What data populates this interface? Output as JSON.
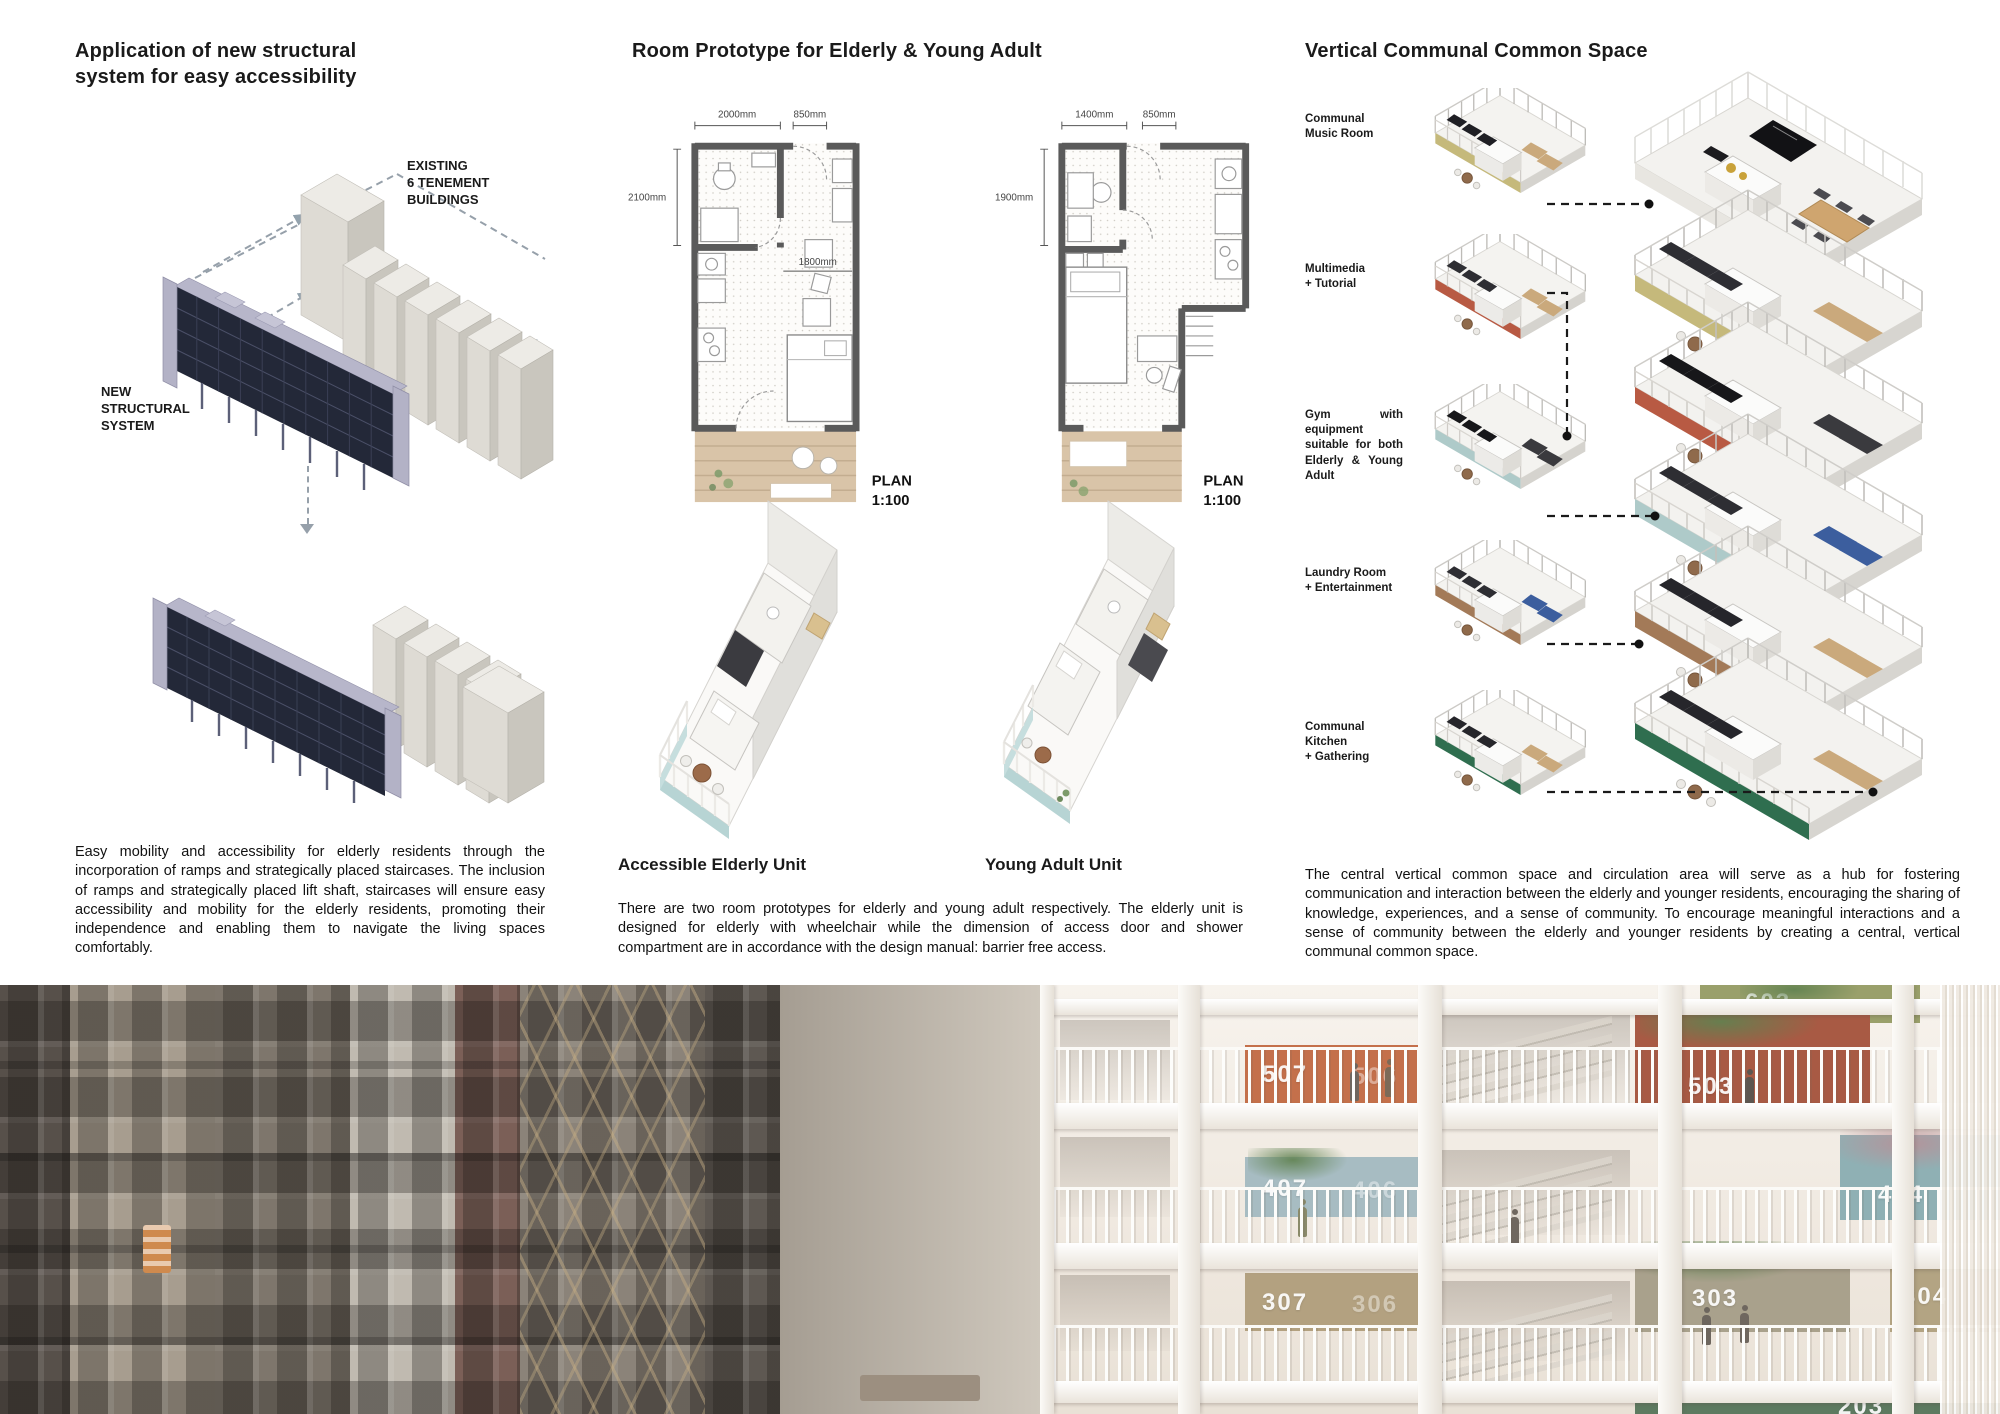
{
  "left": {
    "title": "Application of new structural\nsystem for easy accessibility",
    "existing_label": "EXISTING\n6 TENEMENT\nBUILDINGS",
    "new_label": "NEW\nSTRUCTURAL\nSYSTEM",
    "paragraph": "Easy mobility and accessibility for elderly residents through the incorporation of ramps and strategically placed staircases. The inclusion of ramps and strategically placed lift shaft, staircases will ensure easy accessibility and mobility for the elderly residents, promoting their independence and enabling them to navigate the living spaces comfortably."
  },
  "middle": {
    "title": "Room Prototype for Elderly & Young Adult",
    "elderly_plan": {
      "dim_width_main": "2000mm",
      "dim_width_door": "850mm",
      "dim_height": "2100mm",
      "dim_inner": "1800mm",
      "plan_word": "PLAN",
      "plan_scale": "1:100",
      "caption": "Accessible Elderly Unit"
    },
    "young_plan": {
      "dim_width_main": "1400mm",
      "dim_width_door": "850mm",
      "dim_height": "1900mm",
      "plan_word": "PLAN",
      "plan_scale": "1:100",
      "caption": "Young Adult Unit"
    },
    "paragraph": "There are two room prototypes for elderly and young adult respectively. The elderly unit is designed for elderly with wheelchair while the dimension of access door and shower compartment are in accordance with the design manual: barrier free access."
  },
  "right": {
    "title": "Vertical Communal Common Space",
    "floors": [
      {
        "label": "Communal\nMusic Room",
        "color": "#c5b97b"
      },
      {
        "label": "Multimedia\n+ Tutorial",
        "color": "#b85a43"
      },
      {
        "label": "Gym with equipment suitable for both Elderly & Young Adult",
        "color": "#aecac9"
      },
      {
        "label": "Laundry Room\n+ Entertainment",
        "color": "#a37a58"
      },
      {
        "label": "Communal Kitchen\n+ Gathering",
        "color": "#2f6e4f"
      }
    ],
    "paragraph": "The central vertical common space and circulation area will serve as a hub for fostering communication and interaction between the elderly and younger residents, encouraging the sharing of knowledge, experiences, and a sense of community. To encourage meaningful interactions and a sense of community between the elderly and younger residents by creating a central, vertical communal common space."
  },
  "photo": {
    "numbers": {
      "f6": "603",
      "f5a": "507",
      "f5b": "506",
      "f5c": "503",
      "f4a": "407",
      "f4b": "406",
      "f4c": "404",
      "f3a": "307",
      "f3b": "306",
      "f3c": "303",
      "f3d": "304",
      "f2": "203"
    }
  }
}
